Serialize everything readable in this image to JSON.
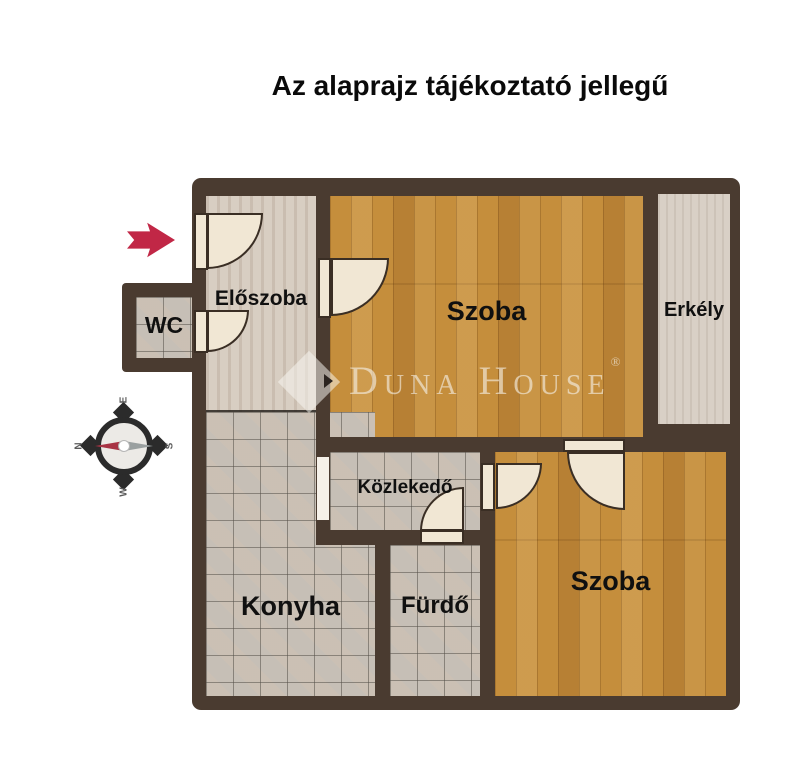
{
  "title": "Az alaprajz tájékoztató jellegű",
  "rooms": {
    "eloszoba": "Előszoba",
    "wc": "WC",
    "szoba1": "Szoba",
    "erkely": "Erkély",
    "kozlekedo": "Közlekedő",
    "konyha": "Konyha",
    "furdo": "Fürdő",
    "szoba2": "Szoba"
  },
  "compass": {
    "top": "E",
    "left": "N",
    "right": "S",
    "bottom": "W"
  },
  "watermark": {
    "text": "Duna House",
    "registered": "®"
  },
  "colors": {
    "wall": "#4a3b30",
    "wood_floor": "#c58e3c",
    "tile_floor": "#c6bfb6",
    "hall_floor": "#d8cec2",
    "door": "#f1e7d4",
    "entry_arrow": "#c12746",
    "label_text": "#101010"
  }
}
